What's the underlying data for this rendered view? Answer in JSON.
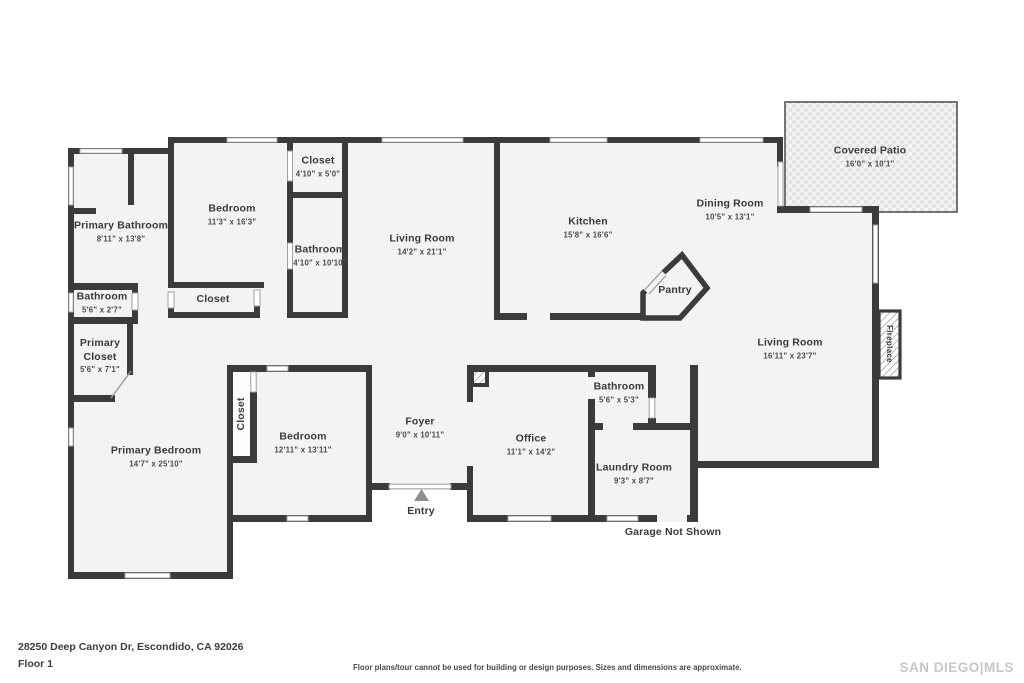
{
  "plan": {
    "wall_color": "#3b3b3b",
    "floor_color": "#f3f3f3",
    "window_color": "#ffffff",
    "labels": [
      {
        "id": "primary-bathroom",
        "name": "Primary Bathroom",
        "dims": "8'11\" x 13'8\"",
        "x": 121,
        "y": 232,
        "rot": 0,
        "variant": ""
      },
      {
        "id": "bedroom-1",
        "name": "Bedroom",
        "dims": "11'3\" x 16'3\"",
        "x": 232,
        "y": 215,
        "rot": 0,
        "variant": ""
      },
      {
        "id": "closet-top",
        "name": "Closet",
        "dims": "4'10\" x 5'0\"",
        "x": 318,
        "y": 167,
        "rot": 0,
        "variant": ""
      },
      {
        "id": "bathroom-hall",
        "name": "Bathroom",
        "dims": "4'10\" x 10'10\"",
        "x": 320,
        "y": 256,
        "rot": 0,
        "variant": ""
      },
      {
        "id": "living-room-center",
        "name": "Living Room",
        "dims": "14'2\" x 21'1\"",
        "x": 422,
        "y": 245,
        "rot": 0,
        "variant": ""
      },
      {
        "id": "kitchen",
        "name": "Kitchen",
        "dims": "15'8\" x 16'6\"",
        "x": 588,
        "y": 228,
        "rot": 0,
        "variant": ""
      },
      {
        "id": "dining-room",
        "name": "Dining Room",
        "dims": "10'5\" x 13'1\"",
        "x": 730,
        "y": 210,
        "rot": 0,
        "variant": ""
      },
      {
        "id": "covered-patio",
        "name": "Covered Patio",
        "dims": "16'0\" x 10'1\"",
        "x": 870,
        "y": 157,
        "rot": 0,
        "variant": ""
      },
      {
        "id": "pantry",
        "name": "Pantry",
        "dims": "",
        "x": 675,
        "y": 291,
        "rot": 0,
        "variant": ""
      },
      {
        "id": "bathroom-small",
        "name": "Bathroom",
        "dims": "5'6\" x 2'7\"",
        "x": 102,
        "y": 303,
        "rot": 0,
        "variant": ""
      },
      {
        "id": "closet-mid",
        "name": "Closet",
        "dims": "",
        "x": 213,
        "y": 300,
        "rot": 0,
        "variant": ""
      },
      {
        "id": "primary-closet",
        "name": "Primary Closet",
        "dims": "5'6\" x 7'1\"",
        "x": 100,
        "y": 356,
        "rot": 0,
        "variant": "wrap"
      },
      {
        "id": "primary-bedroom",
        "name": "Primary Bedroom",
        "dims": "14'7\" x 25'10\"",
        "x": 156,
        "y": 457,
        "rot": 0,
        "variant": ""
      },
      {
        "id": "closet-vertical",
        "name": "Closet",
        "dims": "",
        "x": 242,
        "y": 414,
        "rot": -90,
        "variant": ""
      },
      {
        "id": "bedroom-2",
        "name": "Bedroom",
        "dims": "12'11\" x 13'11\"",
        "x": 303,
        "y": 443,
        "rot": 0,
        "variant": ""
      },
      {
        "id": "foyer",
        "name": "Foyer",
        "dims": "9'0\" x 10'11\"",
        "x": 420,
        "y": 428,
        "rot": 0,
        "variant": ""
      },
      {
        "id": "office",
        "name": "Office",
        "dims": "11'1\" x 14'2\"",
        "x": 531,
        "y": 445,
        "rot": 0,
        "variant": ""
      },
      {
        "id": "bathroom-office",
        "name": "Bathroom",
        "dims": "5'6\" x 5'3\"",
        "x": 619,
        "y": 393,
        "rot": 0,
        "variant": ""
      },
      {
        "id": "laundry-room",
        "name": "Laundry Room",
        "dims": "9'3\" x 8'7\"",
        "x": 634,
        "y": 474,
        "rot": 0,
        "variant": ""
      },
      {
        "id": "living-room-right",
        "name": "Living Room",
        "dims": "16'11\" x 23'7\"",
        "x": 790,
        "y": 349,
        "rot": 0,
        "variant": ""
      },
      {
        "id": "fireplace",
        "name": "Fireplace",
        "dims": "",
        "x": 889,
        "y": 344,
        "rot": 90,
        "variant": "tag"
      },
      {
        "id": "entry",
        "name": "Entry",
        "dims": "",
        "x": 421,
        "y": 512,
        "rot": 0,
        "variant": ""
      },
      {
        "id": "garage-note",
        "name": "Garage Not Shown",
        "dims": "",
        "x": 673,
        "y": 533,
        "rot": 0,
        "variant": ""
      }
    ]
  },
  "footer": {
    "address": "28250 Deep Canyon Dr, Escondido, CA 92026",
    "floor": "Floor 1",
    "disclaimer": "Floor plans/tour cannot be used for building or design purposes. Sizes and dimensions are approximate.",
    "brand": "SAN DIEGO|MLS"
  }
}
